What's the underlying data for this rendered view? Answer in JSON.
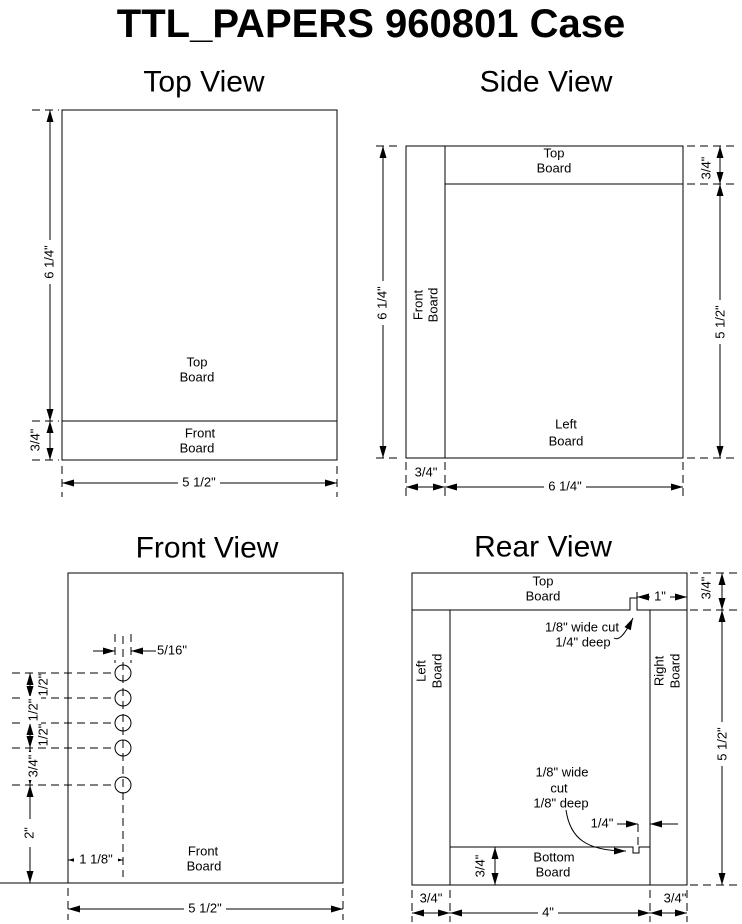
{
  "page_title": "TTL_PAPERS 960801 Case",
  "line_color": "#000000",
  "background_color": "#ffffff",
  "top_view": {
    "title": "Top View",
    "top_board_line1": "Top",
    "top_board_line2": "Board",
    "front_board_line1": "Front",
    "front_board_line2": "Board",
    "dim_height": "6 1/4\"",
    "dim_front_thickness": "3/4\"",
    "dim_width": "5 1/2\""
  },
  "side_view": {
    "title": "Side View",
    "top_board_line1": "Top",
    "top_board_line2": "Board",
    "front_board_line1": "Front",
    "front_board_line2": "Board",
    "left_board_line1": "Left",
    "left_board_line2": "Board",
    "dim_height": "6 1/4\"",
    "dim_top_thickness": "3/4\"",
    "dim_inner_height": "5 1/2\"",
    "dim_front_thickness": "3/4\"",
    "dim_depth": "6 1/4\""
  },
  "front_view": {
    "title": "Front View",
    "front_board_line1": "Front",
    "front_board_line2": "Board",
    "dim_hole_diameter": "5/16\"",
    "dim_gap1": "1/2\"",
    "dim_gap2": "1/2\"",
    "dim_gap3": "1/2\"",
    "dim_gap4": "3/4\"",
    "dim_bottom_offset": "2\"",
    "dim_hole_inset": "1 1/8\"",
    "dim_width": "5 1/2\""
  },
  "rear_view": {
    "title": "Rear View",
    "top_board_line1": "Top",
    "top_board_line2": "Board",
    "left_board_line1": "Left",
    "left_board_line2": "Board",
    "right_board_line1": "Right",
    "right_board_line2": "Board",
    "bottom_board_line1": "Bottom",
    "bottom_board_line2": "Board",
    "top_cut_note_line1": "1/8\" wide cut",
    "top_cut_note_line2": "1/4\" deep",
    "dim_notch_offset": "1\"",
    "dim_top_thickness": "3/4\"",
    "dim_side_height": "5 1/2\"",
    "bottom_cut_note_line1": "1/8\" wide",
    "bottom_cut_note_line2": "cut",
    "bottom_cut_note_line3": "1/8\" deep",
    "dim_bottom_notch_offset": "1/4\"",
    "dim_bottom_thickness": "3/4\"",
    "dim_left_width": "3/4\"",
    "dim_inner_width": "4\"",
    "dim_right_width": "3/4\""
  }
}
